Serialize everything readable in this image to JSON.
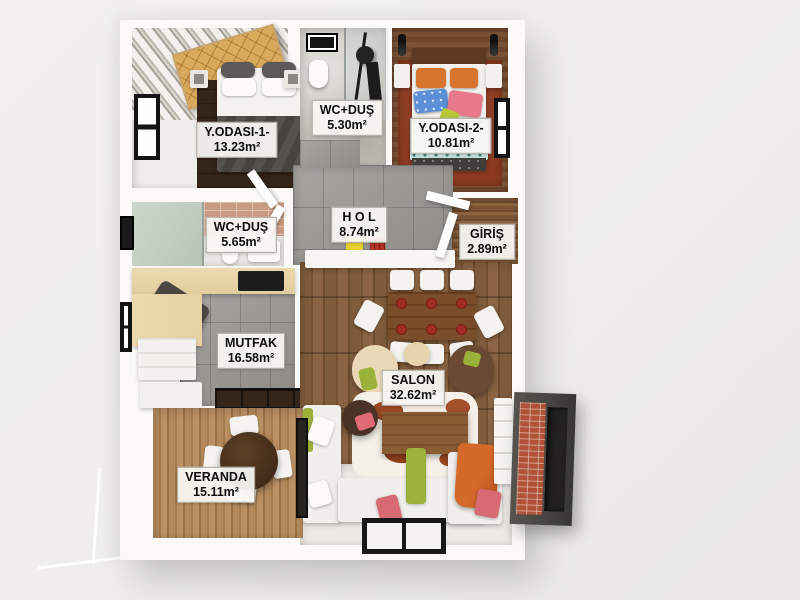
{
  "rooms": [
    {
      "name": "Y.ODASI-1-",
      "area": "13.23m²"
    },
    {
      "name": "WC+DUŞ",
      "area": "5.30m²"
    },
    {
      "name": "Y.ODASI-2-",
      "area": "10.81m²"
    },
    {
      "name": "WC+DUŞ",
      "area": "5.65m²"
    },
    {
      "name": "H O L",
      "area": "8.74m²"
    },
    {
      "name": "GİRİŞ",
      "area": "2.89m²"
    },
    {
      "name": "MUTFAK",
      "area": "16.58m²"
    },
    {
      "name": "SALON",
      "area": "32.62m²"
    },
    {
      "name": "VERANDA",
      "area": "15.11m²"
    }
  ],
  "colors": {
    "background": "#f0efed",
    "wall_white": "#fbfaf7",
    "tile_grey": "#9d9b96",
    "salon_wood": "#7a5638",
    "veranda_deck": "#b08a5c",
    "giris_wood": "#80573a",
    "bedroom2_rug": "#8c3a20",
    "teal_blanket": "#c3e3df",
    "tan_quilt": "#d9a95c",
    "accent_orange": "#d4692a",
    "accent_green": "#9bb23a",
    "accent_pink": "#e07880",
    "accent_yellow": "#e8d22a",
    "brick_red": "#b05238",
    "slate_grey": "#4b4a47"
  }
}
